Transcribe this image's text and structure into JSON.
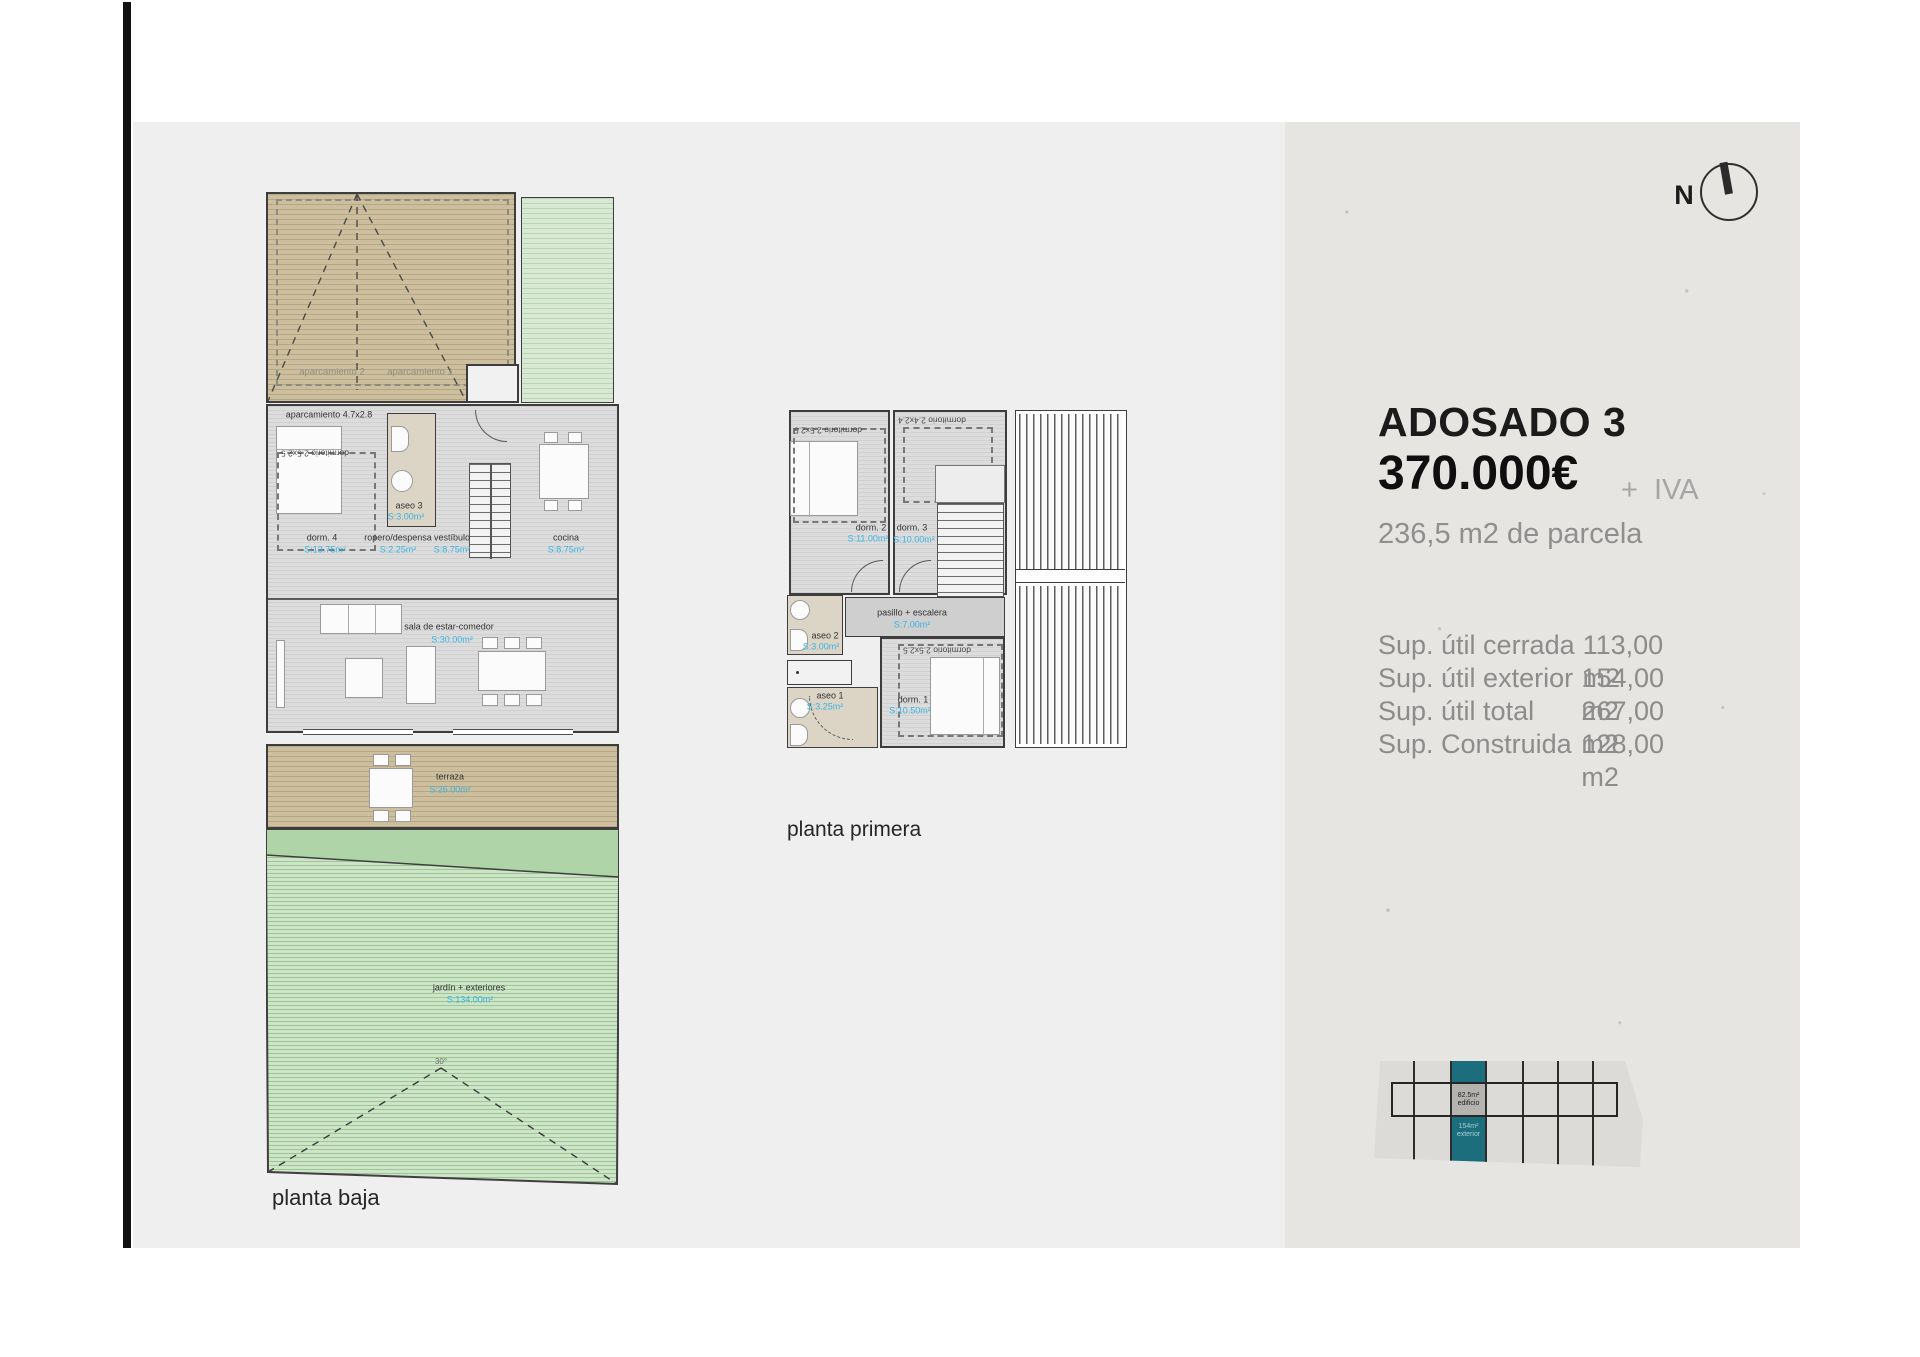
{
  "ground_floor": {
    "caption": "planta baja",
    "parking": {
      "stall_note": "aparcamiento 4.7x2.8",
      "stall_2": "aparcamiento 2",
      "stall_1": "aparcamiento 1"
    },
    "rooms": {
      "dorm4_note": "dormitorio 2.5x2.5",
      "dorm4": {
        "label": "dorm. 4",
        "area": "S:13.75m²"
      },
      "aseo3": {
        "label": "aseo 3",
        "area": "S:3.00m²"
      },
      "ropero": {
        "label": "ropero/despensa",
        "area": "S:2.25m²"
      },
      "vestibulo": {
        "label": "vestíbulo",
        "area": "S:8.75m²"
      },
      "cocina": {
        "label": "cocina",
        "area": "S:8.75m²"
      },
      "sala": {
        "label": "sala de estar-comedor",
        "area": "S:30.00m²"
      },
      "terraza": {
        "label": "terraza",
        "area": "S:26.00m²"
      },
      "jardin": {
        "label": "jardín + exteriores",
        "area": "S:134.00m²"
      }
    },
    "roof_angle": "30°"
  },
  "first_floor": {
    "caption": "planta primera",
    "rooms": {
      "dorm2_note": "dormitorio 2.5x2.5",
      "dorm3_note": "dormitorio 2.4x2.4",
      "dorm1_note": "dormitorio 2.5x2.5",
      "dorm2": {
        "label": "dorm. 2",
        "area": "S:11.00m²"
      },
      "dorm3": {
        "label": "dorm. 3",
        "area": "S:10.00m²"
      },
      "pasillo": {
        "label": "pasillo + escalera",
        "area": "S:7.00m²"
      },
      "aseo2": {
        "label": "aseo 2",
        "area": "S:3.00m²"
      },
      "aseo1": {
        "label": "aseo 1",
        "area": "S:3.25m²"
      },
      "dorm1": {
        "label": "dorm. 1",
        "area": "S:10.50m²"
      }
    }
  },
  "info_panel": {
    "title": "ADOSADO 3",
    "price": "370.000€",
    "tax": "+ IVA",
    "parcel": "236,5 m2 de parcela",
    "surfaces": [
      {
        "label": "Sup. útil cerrada",
        "value": "113,00 m2"
      },
      {
        "label": "Sup. útil exterior",
        "value": "154,00 m2"
      },
      {
        "label": "Sup. útil total",
        "value": "267,00 m2"
      },
      {
        "label": "Sup. Construida",
        "value": "128,00 m2"
      }
    ],
    "compass_label": "N",
    "siteplan": {
      "building_area": "82.5m²",
      "building_label": "edificio",
      "exterior_area": "154m²",
      "exterior_label": "exterior"
    }
  },
  "colors": {
    "accent_blue": "#38b4e3",
    "teal": "#1c6e7d",
    "tan": "#cdbf9e",
    "green_light": "#cbe5c5",
    "green_dark": "#aed4a7"
  }
}
